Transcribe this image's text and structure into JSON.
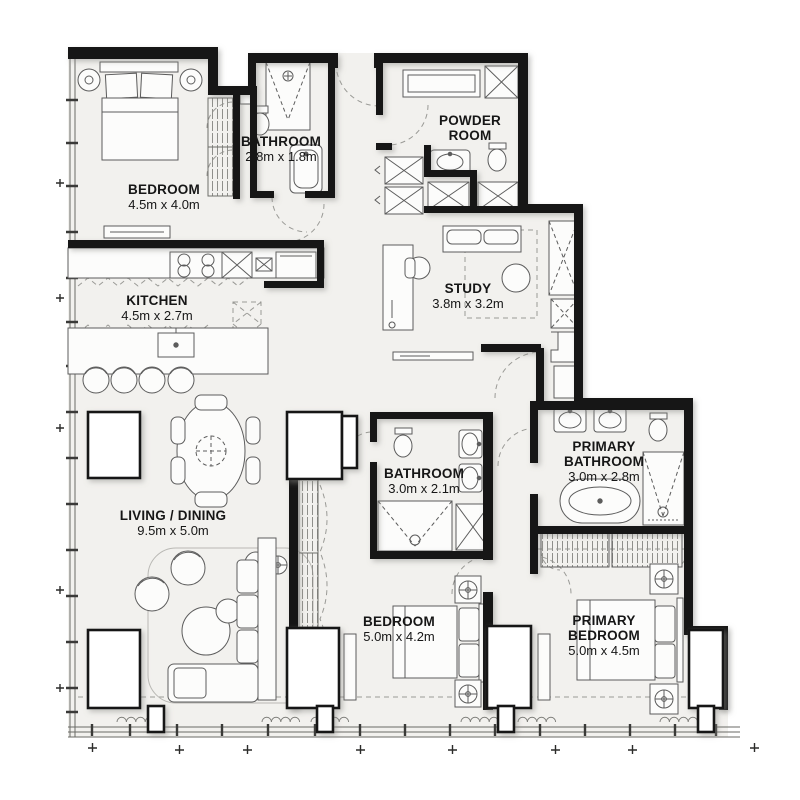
{
  "plan": {
    "type": "apartment-floor-plan",
    "colors": {
      "background": "#ffffff",
      "floor": "#f2f1ee",
      "wall": "#161616",
      "furniture_line": "#5c5c5c",
      "dashed_line": "#9a9a96",
      "label_text": "#161616"
    }
  },
  "rooms": [
    {
      "id": "bedroom-1",
      "name_lines": [
        "BEDROOM"
      ],
      "dims": "4.5m x 4.0m"
    },
    {
      "id": "bathroom-1",
      "name_lines": [
        "BATHROOM"
      ],
      "dims": "2.8m x 1.8m"
    },
    {
      "id": "powder-room",
      "name_lines": [
        "POWDER",
        "ROOM"
      ],
      "dims": ""
    },
    {
      "id": "kitchen",
      "name_lines": [
        "KITCHEN"
      ],
      "dims": "4.5m x 2.7m"
    },
    {
      "id": "study",
      "name_lines": [
        "STUDY"
      ],
      "dims": "3.8m x 3.2m"
    },
    {
      "id": "living-dining",
      "name_lines": [
        "LIVING / DINING"
      ],
      "dims": "9.5m x 5.0m"
    },
    {
      "id": "bathroom-2",
      "name_lines": [
        "BATHROOM"
      ],
      "dims": "3.0m x 2.1m"
    },
    {
      "id": "primary-bathroom",
      "name_lines": [
        "PRIMARY",
        "BATHROOM"
      ],
      "dims": "3.0m x 2.8m"
    },
    {
      "id": "bedroom-2",
      "name_lines": [
        "BEDROOM"
      ],
      "dims": "5.0m x 4.2m"
    },
    {
      "id": "primary-bedroom",
      "name_lines": [
        "PRIMARY",
        "BEDROOM"
      ],
      "dims": "5.0m x 4.5m"
    }
  ]
}
